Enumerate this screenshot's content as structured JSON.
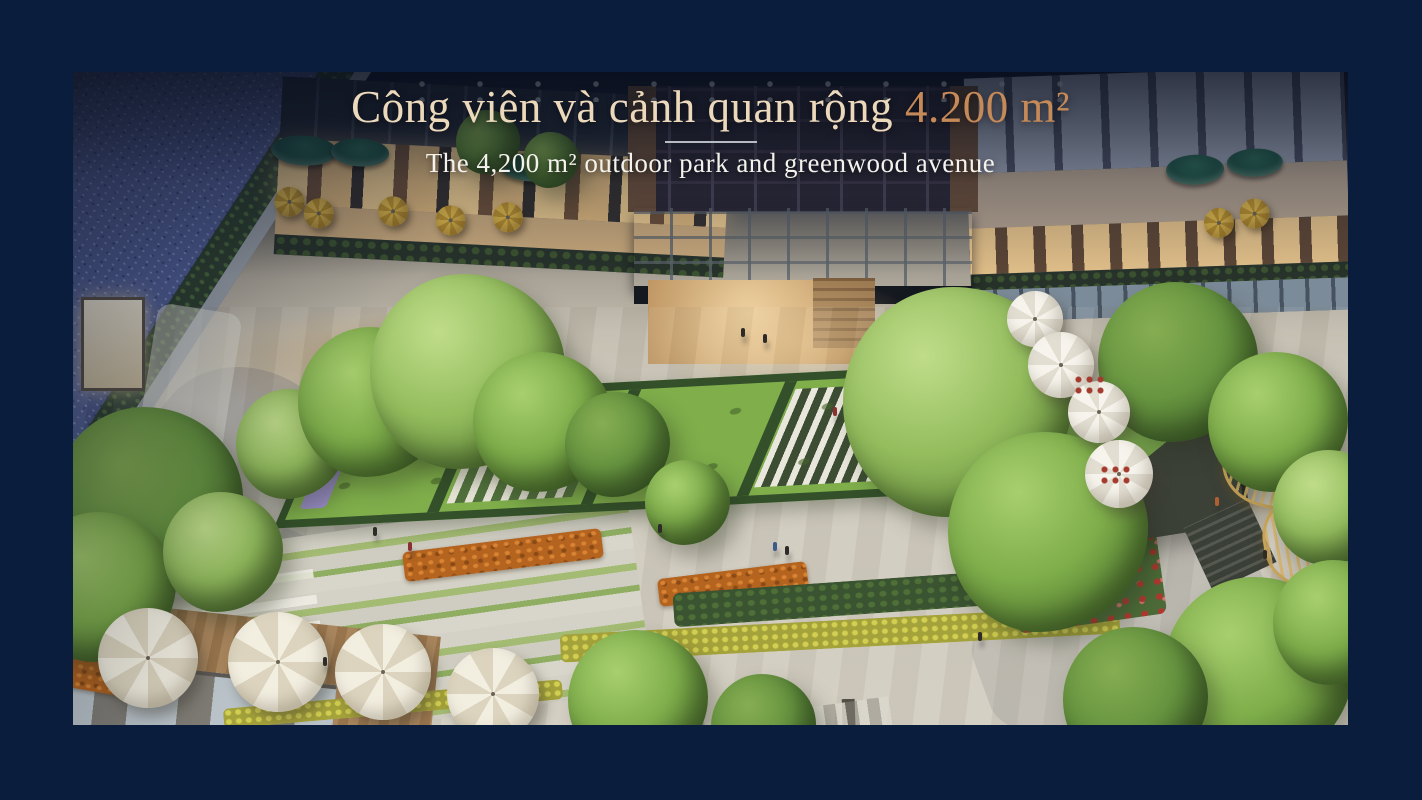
{
  "caption": {
    "title_main": "Công viên và cảnh quan rộng ",
    "title_area": "4.200 m²",
    "subtitle": "The 4,200 m² outdoor park and greenwood avenue"
  },
  "theme": {
    "frame": "#0b1d3d",
    "title": "#ecd9bc",
    "title-accent": "#c68a58",
    "divider": "#c9cdd3",
    "subtitle": "#f4f2ec",
    "pool": "#4e5c94",
    "awning": "#1d5044",
    "hedge": "#33502a",
    "tree": "#7fae4b",
    "flower-orange": "#b5641f",
    "gold": "#c9a55a"
  }
}
